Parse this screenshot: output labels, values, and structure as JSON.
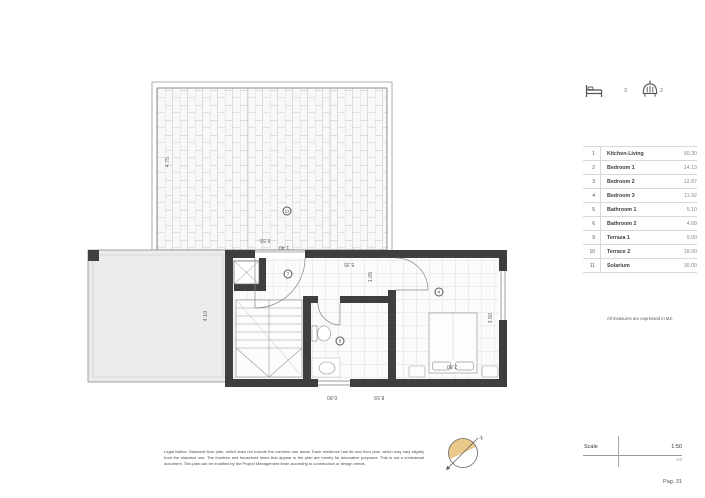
{
  "summary_icons": {
    "bedrooms_icon": "bed-icon",
    "bedrooms": "3",
    "bathrooms_icon": "shower-icon",
    "bathrooms": "2"
  },
  "rooms_table": {
    "rows": [
      {
        "num": "1",
        "name": "Kitchen-Living",
        "area": "50.30"
      },
      {
        "num": "2",
        "name": "Bedroom 1",
        "area": "14.13"
      },
      {
        "num": "3",
        "name": "Bedroom 2",
        "area": "12.87"
      },
      {
        "num": "4",
        "name": "Bedroom 3",
        "area": "11.92"
      },
      {
        "num": "5",
        "name": "Bathroom 1",
        "area": "5.10"
      },
      {
        "num": "6",
        "name": "Bathroom 2",
        "area": "4.68"
      },
      {
        "num": "9",
        "name": "Terraza 1",
        "area": "9.00"
      },
      {
        "num": "10",
        "name": "Terrace 2",
        "area": "18.00"
      },
      {
        "num": "11",
        "name": "Solarium",
        "area": "30.00"
      }
    ],
    "note": "All measures are expressed in M2."
  },
  "plan": {
    "markers": {
      "solarium": "11",
      "landing": "7",
      "bathroom": "6",
      "bedroom": "4"
    },
    "dimensions": {
      "solarium_depth": "4.75",
      "solarium_width": "6.55",
      "door_width": "1.40",
      "hall_length": "5.35",
      "hall_width": "1.05",
      "bedroom_depth": "3.50",
      "bed_width": "2.80",
      "window_width": "0.80",
      "house_width": "8.55",
      "terrace_depth": "4.10"
    }
  },
  "footer": {
    "legal_notice": "Legal Notice: Standard floor plan, which does not include the common use areas. Each residence has its own floor plan, which may vary slightly from the standard one. The furniture and household items that appear in the plan are merely for decorative purposes. This is not a contractual document. This plan can be modified by the Project Management team according to construction or design needs.",
    "scale_label": "Scale",
    "scale_value": "1:50",
    "paper_size": "A3",
    "page": "Pag. 31"
  },
  "colors": {
    "wall": "#3f3f3f",
    "compass_fill": "#eac98b",
    "terrace_fill": "#ebebeb"
  }
}
